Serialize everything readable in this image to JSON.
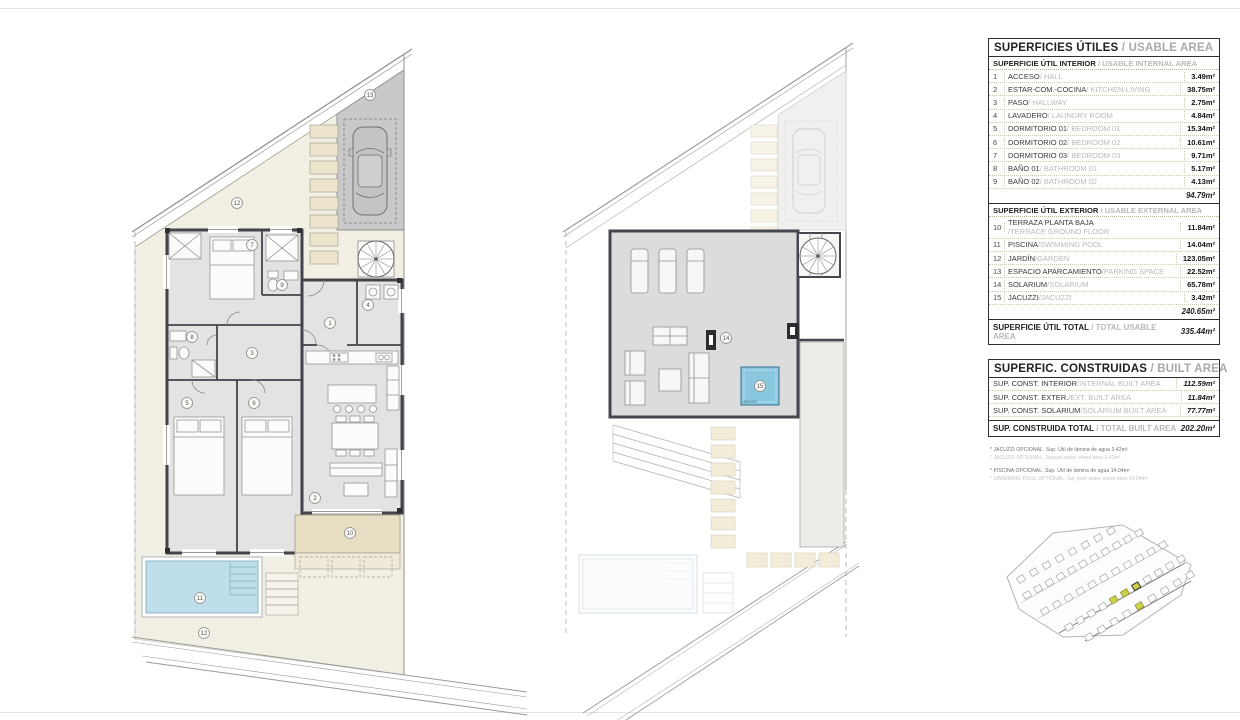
{
  "usable_table": {
    "title_es": "SUPERFICIES ÚTILES",
    "title_en": "/ USABLE AREA",
    "interior": {
      "header_es": "SUPERFICIE ÚTIL INTERIOR",
      "header_en": "/ USABLE INTERNAL AREA",
      "rows": [
        {
          "num": "1",
          "es": "ACCESO",
          "en": "/ HALL",
          "value": "3.49m²"
        },
        {
          "num": "2",
          "es": "ESTAR-COM.-COCINA",
          "en": "/ KITCHEN-LIVING",
          "value": "38.75m²"
        },
        {
          "num": "3",
          "es": "PASO",
          "en": "/ HALLWAY",
          "value": "2.75m²"
        },
        {
          "num": "4",
          "es": "LAVADERO",
          "en": "/ LAUNDRY ROOM",
          "value": "4.84m²"
        },
        {
          "num": "5",
          "es": "DORMITORIO 01",
          "en": "/ BEDROOM 01",
          "value": "15.34m²"
        },
        {
          "num": "6",
          "es": "DORMITORIO 02",
          "en": "/ BEDROOM 02",
          "value": "10.61m²"
        },
        {
          "num": "7",
          "es": "DORMITORIO 03",
          "en": "/ BEDROOM 03",
          "value": "9.71m²"
        },
        {
          "num": "8",
          "es": "BAÑO 01",
          "en": "/ BATHROOM 01",
          "value": "5.17m²"
        },
        {
          "num": "9",
          "es": "BAÑO 02",
          "en": "/ BATHROOM 02",
          "value": "4.13m²"
        }
      ],
      "subtotal": "94.79m²"
    },
    "exterior": {
      "header_es": "SUPERFICIE ÚTIL EXTERIOR",
      "header_en": "/ USABLE EXTERNAL AREA",
      "rows": [
        {
          "num": "10",
          "es": "TERRAZA PLANTA BAJA",
          "en": "/TERRACE GROUND FLOOR",
          "value": "11.84m²",
          "block": true
        },
        {
          "num": "11",
          "es": "PISCINA",
          "en": "/SWIMMING POOL",
          "value": "14.04m²"
        },
        {
          "num": "12",
          "es": "JARDÍN",
          "en": "/GARDEN",
          "value": "123.05m²"
        },
        {
          "num": "13",
          "es": "ESPACIO APARCAMIENTO",
          "en": "/PARKING SPACE",
          "value": "22.52m²"
        },
        {
          "num": "14",
          "es": "SOLARIUM",
          "en": "/SOLARIUM",
          "value": "65.78m²"
        },
        {
          "num": "15",
          "es": "JACUZZI",
          "en": "/JACUZZI",
          "value": "3.42m²"
        }
      ],
      "subtotal": "240.65m²"
    },
    "total": {
      "es": "SUPERFICIE ÚTIL TOTAL",
      "en": "/ TOTAL USABLE AREA",
      "value": "335.44m²"
    }
  },
  "built_table": {
    "title_es": "SUPERFIC. CONSTRUIDAS",
    "title_en": "/ BUILT AREA",
    "rows": [
      {
        "es": "SUP. CONST. INTERIOR",
        "en": "/INTERNAL BUILT AREA",
        "value": "112.59m²"
      },
      {
        "es": "SUP. CONST. EXTER.",
        "en": "/EXT. BUILT AREA",
        "value": "11.84m²"
      },
      {
        "es": "SUP. CONST. SOLARIUM",
        "en": "/SOLARIUM BUILT AREA",
        "value": "77.77m²"
      }
    ],
    "total": {
      "es": "SUP. CONSTRUIDA TOTAL",
      "en": "/ TOTAL BUILT AREA",
      "value": "202.20m²"
    }
  },
  "footnotes": [
    {
      "text": "* JACUZZI OPCIONAL. Sup. Útil de lámina de agua 3.42m²",
      "muted": false,
      "sp": false
    },
    {
      "text": "* JACUZZI OPTIONAL. Jacuzzi water sheet area 3.42m²",
      "muted": true,
      "sp": false
    },
    {
      "text": "* PISCINA OPCIONAL. Sup. Útil de lámina de agua 14.04m²",
      "muted": false,
      "sp": true
    },
    {
      "text": "* SWIMMING POOL OPTIONAL. Sw. pool water sheet area 14.04m²",
      "muted": true,
      "sp": false
    }
  ],
  "plans": {
    "ground": {
      "markers": [
        "1",
        "2",
        "3",
        "4",
        "5",
        "6",
        "7",
        "8",
        "9",
        "10",
        "11",
        "12",
        "13",
        "12"
      ]
    },
    "solarium": {
      "markers": [
        "14",
        "15"
      ],
      "jacuzzi_label": "JACUZZI"
    }
  },
  "colors": {
    "pool": "#bedfea",
    "jacuzzi": "#8ac8df",
    "terrace": "#e7dec4",
    "parking": "#c9c9c9",
    "floor": "#e3e3e3",
    "wall": "#43434b",
    "garden": "#f3f1e6",
    "highlight": "#cdd24a"
  }
}
